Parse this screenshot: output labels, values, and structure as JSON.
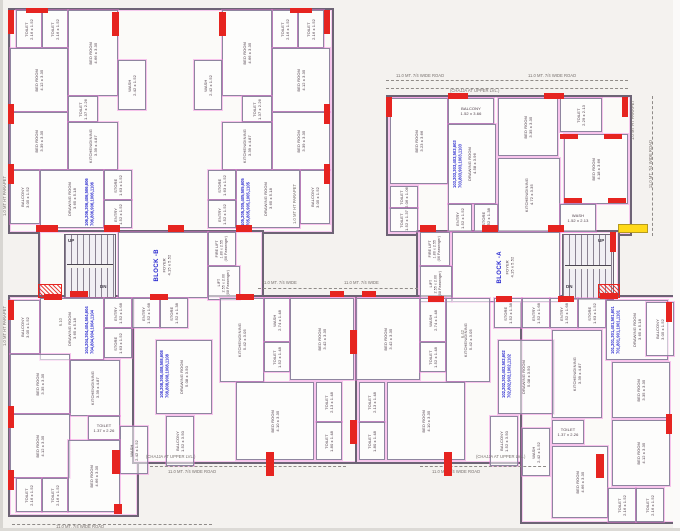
{
  "page": {
    "background": "#f4f2ef",
    "wall_color": "#6d6375",
    "room_line_color": "#8f85a0",
    "centerline_pink": "#f078dc",
    "column_red": "#e62420",
    "unit_blue": "#2a2ace",
    "highlight_yellow": "#ffd918",
    "label_color": "#4a3a45"
  },
  "blocks": {
    "block_b_label": "BLOCK -B",
    "block_a_label": "BLOCK -A",
    "foyer_label": "FOYER",
    "foyer_dims": "4.15 x 5.52"
  },
  "rooms": [
    {
      "t": [
        "TOILET",
        "2.16 x 1.52"
      ],
      "x": 16,
      "y": 10,
      "w": 24,
      "h": 36
    },
    {
      "t": [
        "TOILET",
        "2.16 x 1.52"
      ],
      "x": 42,
      "y": 10,
      "w": 24,
      "h": 36
    },
    {
      "t": [
        "BED ROOM",
        "4.66 x 3.35"
      ],
      "x": 68,
      "y": 10,
      "w": 48,
      "h": 84
    },
    {
      "t": [
        "BED ROOM",
        "4.12 x 3.35"
      ],
      "x": 10,
      "y": 48,
      "w": 56,
      "h": 62
    },
    {
      "t": [
        "BED ROOM",
        "3.39 x 3.35"
      ],
      "x": 10,
      "y": 112,
      "w": 56,
      "h": 56
    },
    {
      "t": [
        "TOILET",
        "1.37 x 2.26"
      ],
      "x": 68,
      "y": 96,
      "w": 28,
      "h": 24
    },
    {
      "t": [
        "KITCHEN/DINING",
        "3.39 x 4.87"
      ],
      "x": 68,
      "y": 122,
      "w": 48,
      "h": 46
    },
    {
      "t": [
        "WASH",
        "2.42 x 1.52"
      ],
      "x": 118,
      "y": 60,
      "w": 26,
      "h": 48
    },
    {
      "t": [
        "BALCONY",
        "3.05 x 1.52"
      ],
      "x": 10,
      "y": 170,
      "w": 28,
      "h": 52
    },
    {
      "t": [
        "DRAWING ROOM",
        "3.65 x 5.18"
      ],
      "x": 40,
      "y": 170,
      "w": 62,
      "h": 56
    },
    {
      "t": [
        "STORE",
        "1.63 x 1.52"
      ],
      "x": 104,
      "y": 170,
      "w": 26,
      "h": 28
    },
    {
      "t": [
        "ENTRY",
        "1.52 x 1.52"
      ],
      "x": 104,
      "y": 200,
      "w": 26,
      "h": 26
    },
    {
      "t": [
        "TOILET",
        "2.16 x 1.52"
      ],
      "x": 272,
      "y": 10,
      "w": 24,
      "h": 36
    },
    {
      "t": [
        "TOILET",
        "2.16 x 1.52"
      ],
      "x": 298,
      "y": 10,
      "w": 24,
      "h": 36
    },
    {
      "t": [
        "BED ROOM",
        "4.66 x 3.35"
      ],
      "x": 222,
      "y": 10,
      "w": 48,
      "h": 84
    },
    {
      "t": [
        "BED ROOM",
        "4.12 x 3.35"
      ],
      "x": 272,
      "y": 48,
      "w": 56,
      "h": 62
    },
    {
      "t": [
        "BED ROOM",
        "3.39 x 3.35"
      ],
      "x": 272,
      "y": 112,
      "w": 56,
      "h": 56
    },
    {
      "t": [
        "TOILET",
        "1.37 x 2.26"
      ],
      "x": 242,
      "y": 96,
      "w": 28,
      "h": 24
    },
    {
      "t": [
        "KITCHEN/DINING",
        "3.39 x 4.87"
      ],
      "x": 222,
      "y": 122,
      "w": 48,
      "h": 46
    },
    {
      "t": [
        "WASH",
        "2.42 x 1.52"
      ],
      "x": 194,
      "y": 60,
      "w": 26,
      "h": 48
    },
    {
      "t": [
        "BALCONY",
        "3.05 x 1.52"
      ],
      "x": 300,
      "y": 170,
      "w": 28,
      "h": 52
    },
    {
      "t": [
        "DRAWING ROOM",
        "3.65 x 5.18"
      ],
      "x": 236,
      "y": 170,
      "w": 62,
      "h": 56
    },
    {
      "t": [
        "STORE",
        "1.63 x 1.52"
      ],
      "x": 208,
      "y": 170,
      "w": 26,
      "h": 28
    },
    {
      "t": [
        "ENTRY",
        "1.52 x 1.52"
      ],
      "x": 208,
      "y": 200,
      "w": 26,
      "h": 26
    },
    {
      "t": [
        "BED ROOM",
        "3.23 x 3.66"
      ],
      "x": 390,
      "y": 98,
      "w": 56,
      "h": 84
    },
    {
      "t": [
        "TOILET",
        "2.06 x 1.06"
      ],
      "x": 390,
      "y": 186,
      "w": 26,
      "h": 20
    },
    {
      "t": [
        "TOILET",
        "1.52 x 1.37"
      ],
      "x": 390,
      "y": 208,
      "w": 26,
      "h": 22
    },
    {
      "t": [
        "BALCONY",
        "1.52 x 3.66"
      ],
      "x": 448,
      "y": 98,
      "w": 44,
      "h": 24,
      "o": "h"
    },
    {
      "t": [
        "DRAWING ROOM",
        "4.58 x 3.96"
      ],
      "x": 448,
      "y": 124,
      "w": 46,
      "h": 78
    },
    {
      "t": [
        "ENTRY",
        "1.52 x 1.52"
      ],
      "x": 448,
      "y": 204,
      "w": 22,
      "h": 26
    },
    {
      "t": [
        "STORE",
        "1.52 x 1.38"
      ],
      "x": 474,
      "y": 204,
      "w": 22,
      "h": 26
    },
    {
      "t": [
        "BED ROOM",
        "3.35 x 3.35"
      ],
      "x": 498,
      "y": 98,
      "w": 58,
      "h": 56
    },
    {
      "t": [
        "KITCHEN/DINING",
        "4.72 x 3.35"
      ],
      "x": 498,
      "y": 158,
      "w": 60,
      "h": 72
    },
    {
      "t": [
        "TOILET",
        "2.29 x 2.13"
      ],
      "x": 560,
      "y": 98,
      "w": 40,
      "h": 32
    },
    {
      "t": [
        "BED ROOM",
        "4.18 x 3.66"
      ],
      "x": 564,
      "y": 134,
      "w": 62,
      "h": 68
    },
    {
      "t": [
        "WASH",
        "1.52 x 2.13"
      ],
      "x": 560,
      "y": 204,
      "w": 34,
      "h": 26,
      "o": "h"
    },
    {
      "t": [
        "BLOCK -B",
        "FOYER",
        "4.15 x 5.52"
      ],
      "x": 118,
      "y": 232,
      "w": 88,
      "h": 64,
      "c": "core"
    },
    {
      "t": [
        "FIRE LIFT",
        "1.80 x 2.55",
        "(06 Passenger)"
      ],
      "x": 208,
      "y": 232,
      "w": 26,
      "h": 32,
      "c": "lift"
    },
    {
      "t": [
        "LIFT",
        "2.55 x 2.00",
        "(08 Passenger)"
      ],
      "x": 208,
      "y": 266,
      "w": 30,
      "h": 32,
      "c": "lift"
    },
    {
      "t": [
        "BLOCK -A",
        "FOYER",
        "4.15 x 5.52"
      ],
      "x": 452,
      "y": 232,
      "w": 106,
      "h": 68,
      "c": "core"
    },
    {
      "t": [
        "FIRE LIFT",
        "1.80 x 2.55",
        "(06 Passenger)"
      ],
      "x": 420,
      "y": 232,
      "w": 28,
      "h": 32,
      "c": "lift"
    },
    {
      "t": [
        "LIFT",
        "2.55 x 2.00",
        "(08 Passenger)"
      ],
      "x": 420,
      "y": 266,
      "w": 30,
      "h": 34,
      "c": "lift"
    },
    {
      "t": [
        "BALCONY",
        "3.05 x 1.52"
      ],
      "x": 10,
      "y": 300,
      "w": 28,
      "h": 52
    },
    {
      "t": [
        "DRAWING ROOM",
        "3.65 x 5.18"
      ],
      "x": 40,
      "y": 298,
      "w": 62,
      "h": 60
    },
    {
      "t": [
        "ENTRY",
        "1.52 x 1.68"
      ],
      "x": 104,
      "y": 298,
      "w": 26,
      "h": 28
    },
    {
      "t": [
        "STORE",
        "1.63 x 1.52"
      ],
      "x": 104,
      "y": 328,
      "w": 26,
      "h": 28
    },
    {
      "t": [
        "BED ROOM",
        "3.35 x 3.35"
      ],
      "x": 10,
      "y": 354,
      "w": 58,
      "h": 58
    },
    {
      "t": [
        "KITCHEN/DINING",
        "3.39 x 4.87"
      ],
      "x": 70,
      "y": 360,
      "w": 48,
      "h": 54
    },
    {
      "t": [
        "TOILET",
        "1.37 x 2.26"
      ],
      "x": 88,
      "y": 416,
      "w": 30,
      "h": 22,
      "o": "h"
    },
    {
      "t": [
        "WASH",
        "2.42 x 1.52"
      ],
      "x": 120,
      "y": 426,
      "w": 26,
      "h": 46
    },
    {
      "t": [
        "BED ROOM",
        "4.12 x 3.35"
      ],
      "x": 10,
      "y": 414,
      "w": 58,
      "h": 62
    },
    {
      "t": [
        "TOILET",
        "2.16 x 1.52"
      ],
      "x": 16,
      "y": 478,
      "w": 24,
      "h": 32
    },
    {
      "t": [
        "TOILET",
        "2.16 x 1.52"
      ],
      "x": 42,
      "y": 478,
      "w": 24,
      "h": 32
    },
    {
      "t": [
        "BED ROOM",
        "4.66 x 3.35"
      ],
      "x": 68,
      "y": 440,
      "w": 50,
      "h": 70
    },
    {
      "t": [
        "ENTRY",
        "1.52 x 1.68"
      ],
      "x": 132,
      "y": 298,
      "w": 26,
      "h": 28
    },
    {
      "t": [
        "STORE",
        "1.52 x 1.38"
      ],
      "x": 160,
      "y": 298,
      "w": 26,
      "h": 28
    },
    {
      "t": [
        "DRAWING ROOM",
        "5.08 x 3.50"
      ],
      "x": 156,
      "y": 340,
      "w": 54,
      "h": 72
    },
    {
      "t": [
        "BALCONY",
        "1.52 x 3.50"
      ],
      "x": 166,
      "y": 416,
      "w": 26,
      "h": 48
    },
    {
      "t": [
        "KITCHEN/DINING",
        "5.42 x 3.05"
      ],
      "x": 220,
      "y": 298,
      "w": 42,
      "h": 82
    },
    {
      "t": [
        "WASH",
        "2.74 x 1.48"
      ],
      "x": 264,
      "y": 298,
      "w": 24,
      "h": 42
    },
    {
      "t": [
        "TOILET",
        "1.52 x 1.48"
      ],
      "x": 264,
      "y": 342,
      "w": 24,
      "h": 28
    },
    {
      "t": [
        "BED ROOM",
        "3.42 x 3.35"
      ],
      "x": 290,
      "y": 298,
      "w": 62,
      "h": 80
    },
    {
      "t": [
        "BED ROOM",
        "4.10 x 3.35"
      ],
      "x": 236,
      "y": 382,
      "w": 76,
      "h": 76
    },
    {
      "t": [
        "TOILET",
        "2.13 x 1.48"
      ],
      "x": 316,
      "y": 382,
      "w": 24,
      "h": 38
    },
    {
      "t": [
        "TOILET",
        "1.80 x 1.48"
      ],
      "x": 316,
      "y": 422,
      "w": 24,
      "h": 36
    },
    {
      "t": [
        "BED ROOM",
        "3.42 x 3.35"
      ],
      "x": 356,
      "y": 298,
      "w": 62,
      "h": 80
    },
    {
      "t": [
        "WASH",
        "2.74 x 1.48"
      ],
      "x": 420,
      "y": 298,
      "w": 24,
      "h": 42
    },
    {
      "t": [
        "TOILET",
        "1.52 x 1.48"
      ],
      "x": 420,
      "y": 342,
      "w": 24,
      "h": 28
    },
    {
      "t": [
        "KITCHEN/DINING",
        "5.42 x 3.05"
      ],
      "x": 446,
      "y": 298,
      "w": 42,
      "h": 82
    },
    {
      "t": [
        "DRAWING ROOM",
        "5.08 x 3.50"
      ],
      "x": 498,
      "y": 340,
      "w": 54,
      "h": 72
    },
    {
      "t": [
        "BALCONY",
        "1.52 x 3.50"
      ],
      "x": 490,
      "y": 416,
      "w": 26,
      "h": 48
    },
    {
      "t": [
        "STORE",
        "1.52 x 1.38"
      ],
      "x": 494,
      "y": 298,
      "w": 26,
      "h": 28
    },
    {
      "t": [
        "ENTRY",
        "1.52 x 1.68"
      ],
      "x": 522,
      "y": 298,
      "w": 26,
      "h": 28
    },
    {
      "t": [
        "BED ROOM",
        "4.10 x 3.35"
      ],
      "x": 387,
      "y": 382,
      "w": 76,
      "h": 76
    },
    {
      "t": [
        "TOILET",
        "2.13 x 1.48"
      ],
      "x": 359,
      "y": 382,
      "w": 24,
      "h": 38
    },
    {
      "t": [
        "TOILET",
        "1.80 x 1.48"
      ],
      "x": 359,
      "y": 422,
      "w": 24,
      "h": 36
    },
    {
      "t": [
        "ENTRY",
        "1.52 x 1.68"
      ],
      "x": 550,
      "y": 298,
      "w": 26,
      "h": 28
    },
    {
      "t": [
        "STORE",
        "1.63 x 1.52"
      ],
      "x": 578,
      "y": 298,
      "w": 26,
      "h": 28
    },
    {
      "t": [
        "DRAWING ROOM",
        "3.65 x 5.18"
      ],
      "x": 606,
      "y": 300,
      "w": 60,
      "h": 58
    },
    {
      "t": [
        "BALCONY",
        "3.05 x 1.52"
      ],
      "x": 646,
      "y": 302,
      "w": 26,
      "h": 52
    },
    {
      "t": [
        "BED ROOM",
        "3.35 x 3.35"
      ],
      "x": 612,
      "y": 362,
      "w": 56,
      "h": 54
    },
    {
      "t": [
        "KITCHEN/DINING",
        "3.39 x 4.87"
      ],
      "x": 552,
      "y": 330,
      "w": 48,
      "h": 86
    },
    {
      "t": [
        "TOILET",
        "1.37 x 2.26"
      ],
      "x": 552,
      "y": 420,
      "w": 30,
      "h": 22,
      "o": "h"
    },
    {
      "t": [
        "WASH",
        "2.42 x 1.52"
      ],
      "x": 522,
      "y": 428,
      "w": 26,
      "h": 46
    },
    {
      "t": [
        "BED ROOM",
        "4.12 x 3.35"
      ],
      "x": 612,
      "y": 420,
      "w": 56,
      "h": 64
    },
    {
      "t": [
        "BED ROOM",
        "4.66 x 3.35"
      ],
      "x": 552,
      "y": 446,
      "w": 54,
      "h": 70
    },
    {
      "t": [
        "TOILET",
        "2.16 x 1.52"
      ],
      "x": 608,
      "y": 488,
      "w": 26,
      "h": 32
    },
    {
      "t": [
        "TOILET",
        "2.16 x 1.52"
      ],
      "x": 636,
      "y": 488,
      "w": 26,
      "h": 32
    }
  ],
  "units": [
    {
      "lines": [
        "106,206,306,406,506,606",
        "706,806,906,1006,1106"
      ],
      "x": 84,
      "y": 178,
      "w": 14,
      "h": 48
    },
    {
      "lines": [
        "105,205,305,405,505,605",
        "705,805,905,1005,1105"
      ],
      "x": 240,
      "y": 178,
      "w": 14,
      "h": 48
    },
    {
      "lines": [
        "103,203,303,403,503,603",
        "703,803,903,1003,1103"
      ],
      "x": 452,
      "y": 138,
      "w": 13,
      "h": 50
    },
    {
      "lines": [
        "104,204,304,404,504,604",
        "704,804,904,1004,1104"
      ],
      "x": 84,
      "y": 306,
      "w": 13,
      "h": 48
    },
    {
      "lines": [
        "108,208,308,408,508,608",
        "708,808,908,1008,1108"
      ],
      "x": 159,
      "y": 350,
      "w": 12,
      "h": 48
    },
    {
      "lines": [
        "102,202,302,402,502,602",
        "702,802,902,1002,1102"
      ],
      "x": 501,
      "y": 350,
      "w": 12,
      "h": 48
    },
    {
      "lines": [
        "101,201,301,401,501,601",
        "701,801,901,1001,1101"
      ],
      "x": 610,
      "y": 308,
      "w": 13,
      "h": 46
    }
  ],
  "annotations": [
    {
      "t": "11.0 MT. 7/4 WIDE ROAD",
      "x": 396,
      "y": 73,
      "o": "h",
      "c": "dim"
    },
    {
      "t": "11.0 MT. 7/4 WIDE ROAD",
      "x": 528,
      "y": 73,
      "o": "h",
      "c": "dim"
    },
    {
      "t": "11.0 MT. 7/4 WIDE ROAD",
      "x": 648,
      "y": 140,
      "o": "v",
      "c": "dim"
    },
    {
      "t": "11.0 MT. 7/4 WIDE ROAD",
      "x": 168,
      "y": 469,
      "o": "h",
      "c": "dim"
    },
    {
      "t": "11.0 MT. 7/4 WIDE ROAD",
      "x": 432,
      "y": 469,
      "o": "h",
      "c": "dim"
    },
    {
      "t": "11.0 MT. 7/4 WIDE ROAD",
      "x": 56,
      "y": 524,
      "o": "h",
      "c": "dim"
    },
    {
      "t": "11.0 MT. 7/4 WIDE",
      "x": 262,
      "y": 280,
      "o": "h",
      "c": "dim"
    },
    {
      "t": "11.0 MT. 7/4 WIDE",
      "x": 344,
      "y": 280,
      "o": "h",
      "c": "dim"
    },
    {
      "t": "1.0 MT HT PARAPET",
      "x": 2,
      "y": 176,
      "o": "v",
      "c": "dim"
    },
    {
      "t": "1.0 MT HT PARAPET",
      "x": 292,
      "y": 184,
      "o": "v",
      "c": "dim"
    },
    {
      "t": "1.0 MT HT PARAPET",
      "x": 630,
      "y": 100,
      "o": "v",
      "c": "dim"
    },
    {
      "t": "1.0 MT HT PARAPET",
      "x": 2,
      "y": 306,
      "o": "v",
      "c": "dim"
    },
    {
      "t": "(CHAJJA AT UPPER LVL.)",
      "x": 146,
      "y": 454,
      "o": "h",
      "c": "dim"
    },
    {
      "t": "(CHAJJA AT UPPER LVL.)",
      "x": 476,
      "y": 454,
      "o": "h",
      "c": "dim"
    },
    {
      "t": "(CHAJJA AT UPPER LVL.)",
      "x": 450,
      "y": 88,
      "o": "h",
      "c": "dim"
    },
    {
      "t": "UP",
      "x": 68,
      "y": 238,
      "o": "h",
      "c": "st"
    },
    {
      "t": "DN",
      "x": 100,
      "y": 284,
      "o": "h",
      "c": "st"
    },
    {
      "t": "UP",
      "x": 598,
      "y": 238,
      "o": "h",
      "c": "st"
    },
    {
      "t": "DN",
      "x": 566,
      "y": 284,
      "o": "h",
      "c": "st"
    },
    {
      "t": "6.10",
      "x": 58,
      "y": 318,
      "o": "v",
      "c": "dim"
    },
    {
      "t": "6.42",
      "x": 460,
      "y": 330,
      "o": "v",
      "c": "dim"
    }
  ],
  "columns": [
    [
      8,
      10,
      6,
      24
    ],
    [
      26,
      8,
      22,
      5
    ],
    [
      112,
      12,
      7,
      24
    ],
    [
      219,
      12,
      7,
      24
    ],
    [
      290,
      8,
      22,
      5
    ],
    [
      324,
      10,
      6,
      24
    ],
    [
      8,
      104,
      6,
      20
    ],
    [
      324,
      104,
      6,
      20
    ],
    [
      8,
      164,
      6,
      20
    ],
    [
      324,
      164,
      6,
      20
    ],
    [
      36,
      225,
      22,
      7
    ],
    [
      104,
      225,
      16,
      7
    ],
    [
      168,
      225,
      16,
      7
    ],
    [
      236,
      225,
      16,
      7
    ],
    [
      44,
      294,
      18,
      6
    ],
    [
      150,
      294,
      18,
      6
    ],
    [
      236,
      294,
      18,
      6
    ],
    [
      386,
      97,
      6,
      20
    ],
    [
      448,
      93,
      20,
      6
    ],
    [
      544,
      93,
      20,
      6
    ],
    [
      560,
      134,
      18,
      5
    ],
    [
      604,
      134,
      18,
      5
    ],
    [
      564,
      198,
      18,
      5
    ],
    [
      608,
      198,
      18,
      5
    ],
    [
      622,
      97,
      6,
      20
    ],
    [
      420,
      225,
      16,
      7
    ],
    [
      482,
      225,
      16,
      7
    ],
    [
      548,
      225,
      16,
      7
    ],
    [
      610,
      232,
      6,
      20
    ],
    [
      428,
      296,
      16,
      6
    ],
    [
      496,
      296,
      16,
      6
    ],
    [
      558,
      296,
      16,
      6
    ],
    [
      70,
      291,
      18,
      6
    ],
    [
      330,
      291,
      14,
      6
    ],
    [
      362,
      291,
      14,
      6
    ],
    [
      600,
      293,
      18,
      6
    ],
    [
      350,
      330,
      7,
      24
    ],
    [
      350,
      420,
      7,
      24
    ],
    [
      8,
      300,
      6,
      20
    ],
    [
      8,
      406,
      6,
      22
    ],
    [
      8,
      470,
      6,
      20
    ],
    [
      112,
      450,
      8,
      24
    ],
    [
      266,
      452,
      8,
      24
    ],
    [
      444,
      452,
      8,
      24
    ],
    [
      596,
      454,
      8,
      24
    ],
    [
      114,
      504,
      8,
      10
    ],
    [
      666,
      302,
      6,
      20
    ],
    [
      666,
      414,
      6,
      20
    ]
  ],
  "markers": [
    {
      "x": 618,
      "y": 224,
      "w": 28,
      "h": 7,
      "k": "yellow"
    },
    {
      "x": 38,
      "y": 284,
      "w": 22,
      "h": 12,
      "k": "hatch"
    },
    {
      "x": 598,
      "y": 284,
      "w": 20,
      "h": 12,
      "k": "hatch"
    }
  ],
  "dim_lines": [
    {
      "x": 386,
      "y": 80,
      "l": 242,
      "o": "h"
    },
    {
      "x": 386,
      "y": 88,
      "l": 242,
      "o": "h"
    },
    {
      "x": 652,
      "y": 96,
      "l": 140,
      "o": "v"
    },
    {
      "x": 150,
      "y": 466,
      "l": 196,
      "o": "h"
    },
    {
      "x": 420,
      "y": 466,
      "l": 126,
      "o": "h"
    },
    {
      "x": 12,
      "y": 524,
      "l": 200,
      "o": "h"
    },
    {
      "x": 258,
      "y": 288,
      "l": 160,
      "o": "h"
    }
  ]
}
